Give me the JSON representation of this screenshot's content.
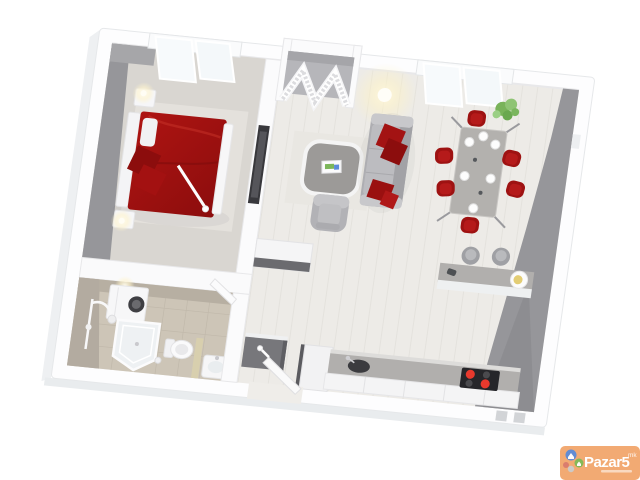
{
  "watermark": {
    "brand": "Pazar5",
    "suffix": "mk"
  },
  "colors": {
    "accent_red": "#ae1412",
    "bed_shadow": "#8c0d0d",
    "chair_red": "#9e1212",
    "sofa_gray": "#bcbcc0",
    "wall_gray": "#96969a",
    "counter_gray": "#b1afad",
    "bath_tile": "#b3aba0",
    "bath_floor": "#cdc5b7",
    "floor_light": "#edebe7",
    "tv_dark": "#38383c",
    "plant_green": "#79b35a",
    "burner_red": "#e8392d",
    "watermark_orange": "#ef9550",
    "watermark_text": "#ffffff"
  },
  "scene": {
    "type": "3d-apartment-floor-plan",
    "rooms": [
      "bedroom",
      "bathroom",
      "hallway",
      "closet",
      "living-room",
      "dining-area",
      "kitchen"
    ],
    "furniture": {
      "bedroom": [
        "double-bed-red",
        "headboard",
        "nightstand-lamp-left",
        "nightstand-lamp-right",
        "wall-tv",
        "floor-lamp"
      ],
      "bathroom": [
        "washing-machine",
        "corner-shower",
        "shower-column",
        "toilet",
        "washbasin"
      ],
      "living-room": [
        "sofa-gray-red-pillows",
        "coffee-table",
        "armchair",
        "tv-lowboard",
        "rug",
        "ceiling-lamp"
      ],
      "dining-area": [
        "dining-table",
        "red-chairs-x6",
        "place-settings-x6",
        "plant"
      ],
      "kitchen": [
        "counter-with-sink",
        "cooktop-red-burners",
        "tall-cabinet",
        "breakfast-bar",
        "bar-stools-x2",
        "plate-of-food"
      ],
      "hallway": [
        "louvered-closet-doors",
        "entry-door-open",
        "shoe-cabinet",
        "bathroom-door-open"
      ]
    },
    "windows": [
      "bedroom-window",
      "living-room-window"
    ]
  }
}
